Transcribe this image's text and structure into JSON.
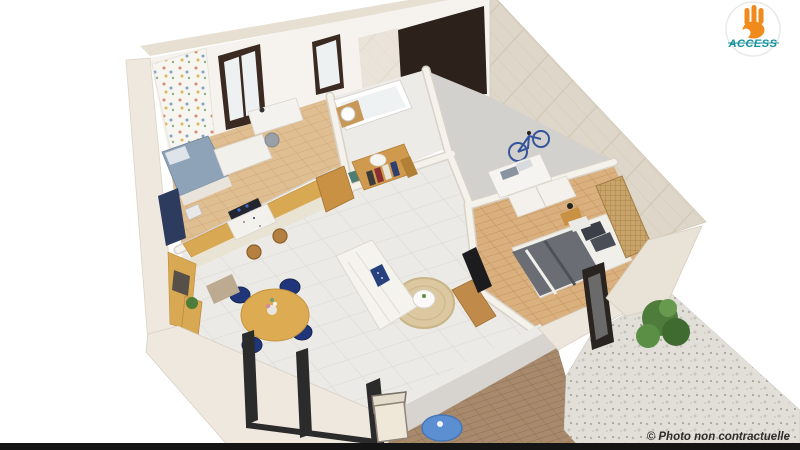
{
  "logo": {
    "brand": "ACCESS"
  },
  "footer": {
    "copyright": "© Photo non contractuelle"
  },
  "palette": {
    "background": "#ffffff",
    "wall_face": "#f6f3ee",
    "wall_stone": "#ded6c8",
    "wall_band": "#eee8df",
    "garage_door": "#2d211c",
    "tile_floor": "#ebeae6",
    "wood_floor_kids": "#dfbe92",
    "wood_floor_bedroom": "#d9b07e",
    "concrete_floor": "#d3d1cd",
    "deck_wood": "#a8896b",
    "gravel": "#e2dfd9",
    "kitchen_counter_wood": "#d9a853",
    "cabinet_cream": "#e9e3d3",
    "navy_accent": "#24386b",
    "dining_table_wood": "#dcab52",
    "sofa_white": "#f5f3ee",
    "rug_jute": "#dcc8a0",
    "bed_blanket_gray": "#6a6d73",
    "rattan_screen": "#c9a46a",
    "bush_green": "#4e7c3a",
    "outdoor_table_blue": "#5b8fd2",
    "logo_orange": "#f08a1d",
    "logo_teal": "#15929e",
    "copyright_color": "#2e2d2b",
    "bottom_strip": "#141414"
  }
}
